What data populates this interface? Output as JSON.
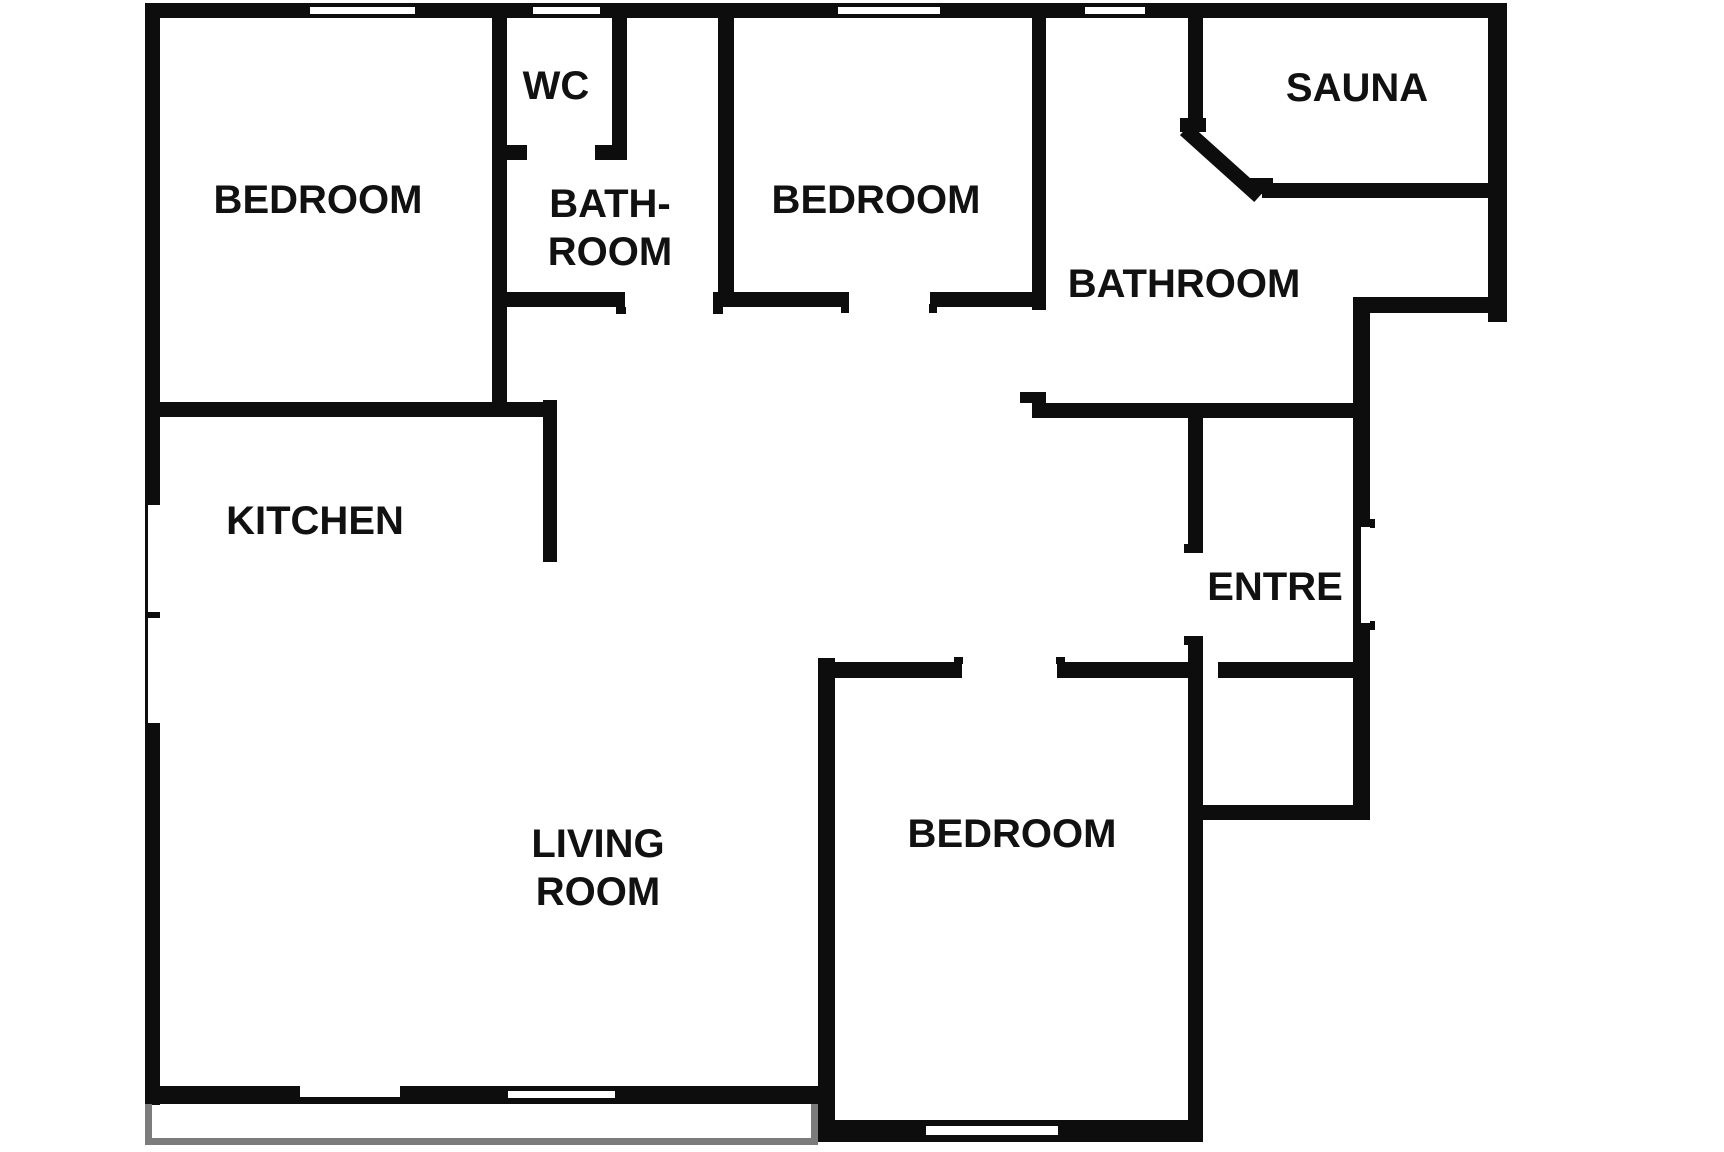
{
  "plan": {
    "canvas": {
      "width": 1724,
      "height": 1152
    },
    "colors": {
      "wall": "#0d0d0d",
      "background": "#ffffff",
      "balcony": "#7c7c7c",
      "text": "#111111"
    },
    "labels": [
      {
        "id": "bedroom-1",
        "text": "BEDROOM",
        "x": 318,
        "y": 200,
        "size": 40
      },
      {
        "id": "wc",
        "text": "WC",
        "x": 556,
        "y": 86,
        "size": 40
      },
      {
        "id": "bath-room",
        "text": "BATH-\nROOM",
        "x": 610,
        "y": 228,
        "size": 40
      },
      {
        "id": "bedroom-2",
        "text": "BEDROOM",
        "x": 876,
        "y": 200,
        "size": 40
      },
      {
        "id": "sauna",
        "text": "SAUNA",
        "x": 1357,
        "y": 88,
        "size": 40
      },
      {
        "id": "bathroom",
        "text": "BATHROOM",
        "x": 1184,
        "y": 284,
        "size": 40
      },
      {
        "id": "kitchen",
        "text": "KITCHEN",
        "x": 315,
        "y": 521,
        "size": 40
      },
      {
        "id": "entre",
        "text": "ENTRE",
        "x": 1275,
        "y": 587,
        "size": 40
      },
      {
        "id": "living-room",
        "text": "LIVING\nROOM",
        "x": 598,
        "y": 868,
        "size": 40
      },
      {
        "id": "bedroom-3",
        "text": "BEDROOM",
        "x": 1012,
        "y": 834,
        "size": 40
      }
    ],
    "walls": [
      {
        "name": "outer-top-wall",
        "x": 145,
        "y": 3,
        "w": 1362,
        "h": 15
      },
      {
        "name": "outer-left-wall",
        "x": 145,
        "y": 3,
        "w": 15,
        "h": 1102
      },
      {
        "name": "outer-right-wall",
        "x": 1488,
        "y": 3,
        "w": 19,
        "h": 319
      },
      {
        "name": "outer-step-wall",
        "x": 1353,
        "y": 297,
        "w": 154,
        "h": 16
      },
      {
        "name": "entre-right-outer-wall",
        "x": 1353,
        "y": 297,
        "w": 17,
        "h": 523
      },
      {
        "name": "livingroom-bottom-wall",
        "x": 145,
        "y": 1086,
        "w": 690,
        "h": 18
      },
      {
        "name": "bedroom3-bottom-wall",
        "x": 818,
        "y": 1120,
        "w": 385,
        "h": 22
      },
      {
        "name": "bedroom1-right-wall",
        "x": 492,
        "y": 18,
        "w": 15,
        "h": 389
      },
      {
        "name": "wc-right-wall",
        "x": 612,
        "y": 18,
        "w": 15,
        "h": 142
      },
      {
        "name": "wc-bottom-wall-left",
        "x": 492,
        "y": 145,
        "w": 35,
        "h": 15
      },
      {
        "name": "wc-bottom-wall-right",
        "x": 595,
        "y": 145,
        "w": 32,
        "h": 15
      },
      {
        "name": "bedroom2-left-wall",
        "x": 718,
        "y": 18,
        "w": 16,
        "h": 289
      },
      {
        "name": "hall-top-wall-a",
        "x": 492,
        "y": 292,
        "w": 133,
        "h": 15
      },
      {
        "name": "hall-top-wall-b",
        "x": 713,
        "y": 292,
        "w": 136,
        "h": 15
      },
      {
        "name": "hall-top-wall-c",
        "x": 930,
        "y": 292,
        "w": 116,
        "h": 15
      },
      {
        "name": "bedroom2-right-wall-upper",
        "x": 1032,
        "y": 18,
        "w": 14,
        "h": 292
      },
      {
        "name": "bathroom-left-wall-lower",
        "x": 1032,
        "y": 392,
        "w": 14,
        "h": 26
      },
      {
        "name": "kitchen-top-wall",
        "x": 145,
        "y": 402,
        "w": 412,
        "h": 15
      },
      {
        "name": "kitchen-right-wall",
        "x": 543,
        "y": 400,
        "w": 14,
        "h": 162
      },
      {
        "name": "sauna-left-wall",
        "x": 1188,
        "y": 18,
        "w": 15,
        "h": 110
      },
      {
        "name": "sauna-bottom-wall",
        "x": 1262,
        "y": 183,
        "w": 226,
        "h": 15
      },
      {
        "name": "bathroom-bottom-wall",
        "x": 1032,
        "y": 403,
        "w": 338,
        "h": 15
      },
      {
        "name": "entre-left-wall-upper",
        "x": 1188,
        "y": 415,
        "w": 15,
        "h": 138
      },
      {
        "name": "entre-left-wall-lower",
        "x": 1188,
        "y": 637,
        "w": 15,
        "h": 505
      },
      {
        "name": "bedroom3-top-wall-a",
        "x": 818,
        "y": 662,
        "w": 144,
        "h": 16
      },
      {
        "name": "bedroom3-top-wall-b",
        "x": 1057,
        "y": 662,
        "w": 146,
        "h": 16
      },
      {
        "name": "entre-bottom-wall",
        "x": 1218,
        "y": 662,
        "w": 152,
        "h": 16
      },
      {
        "name": "closet-bottom-wall",
        "x": 1188,
        "y": 805,
        "w": 182,
        "h": 15
      },
      {
        "name": "livingroom-bedroom3-divider",
        "x": 818,
        "y": 658,
        "w": 17,
        "h": 484
      }
    ],
    "nubs": [
      {
        "name": "bathroom-small-door-jamb-left",
        "x": 616,
        "y": 307,
        "w": 10,
        "h": 7
      },
      {
        "name": "bathroom-small-door-jamb-right",
        "x": 713,
        "y": 307,
        "w": 10,
        "h": 7
      },
      {
        "name": "bedroom2-door-jamb-left",
        "x": 841,
        "y": 304,
        "w": 8,
        "h": 9
      },
      {
        "name": "bedroom2-door-jamb-right",
        "x": 929,
        "y": 304,
        "w": 8,
        "h": 9
      },
      {
        "name": "bathroom-door-jamb",
        "x": 1020,
        "y": 392,
        "w": 12,
        "h": 11
      },
      {
        "name": "entre-door-jamb-top",
        "x": 1184,
        "y": 544,
        "w": 19,
        "h": 9
      },
      {
        "name": "entre-door-jamb-bottom",
        "x": 1184,
        "y": 636,
        "w": 19,
        "h": 9
      },
      {
        "name": "outer-door-jamb-top",
        "x": 1353,
        "y": 519,
        "w": 22,
        "h": 9
      },
      {
        "name": "outer-door-jamb-bottom",
        "x": 1353,
        "y": 621,
        "w": 22,
        "h": 9
      },
      {
        "name": "sauna-door-jamb-top",
        "x": 1180,
        "y": 118,
        "w": 26,
        "h": 14
      },
      {
        "name": "sauna-door-jamb-bottom",
        "x": 1247,
        "y": 178,
        "w": 26,
        "h": 16
      },
      {
        "name": "bedroom3-door-jamb-left",
        "x": 954,
        "y": 657,
        "w": 9,
        "h": 7
      },
      {
        "name": "bedroom3-door-jamb-right",
        "x": 1056,
        "y": 657,
        "w": 9,
        "h": 7
      }
    ],
    "diagonal": {
      "name": "sauna-diagonal-wall",
      "x": 1190,
      "y": 124,
      "len": 100,
      "h": 15,
      "angle": 42
    },
    "slots": [
      {
        "name": "window-top-bedroom1",
        "x": 310,
        "y": 7,
        "w": 105,
        "h": 7
      },
      {
        "name": "window-top-wc",
        "x": 533,
        "y": 7,
        "w": 67,
        "h": 7
      },
      {
        "name": "window-top-bedroom2",
        "x": 838,
        "y": 7,
        "w": 102,
        "h": 7
      },
      {
        "name": "window-top-bathroom",
        "x": 1085,
        "y": 7,
        "w": 60,
        "h": 7
      },
      {
        "name": "window-left-kitchen-a",
        "x": 148,
        "y": 505,
        "w": 12,
        "h": 107
      },
      {
        "name": "window-left-kitchen-b",
        "x": 148,
        "y": 618,
        "w": 12,
        "h": 105
      },
      {
        "name": "balcony-door-notch",
        "x": 300,
        "y": 1086,
        "w": 100,
        "h": 11
      },
      {
        "name": "window-bottom-living",
        "x": 508,
        "y": 1091,
        "w": 107,
        "h": 7
      },
      {
        "name": "window-bottom-bedroom3",
        "x": 926,
        "y": 1126,
        "w": 132,
        "h": 9
      },
      {
        "name": "entrance-door-notch",
        "x": 1361,
        "y": 527,
        "w": 9,
        "h": 96
      }
    ],
    "balcony": [
      {
        "name": "balcony-left-edge",
        "x": 145,
        "y": 1104,
        "w": 7,
        "h": 41
      },
      {
        "name": "balcony-bottom-edge",
        "x": 145,
        "y": 1138,
        "w": 673,
        "h": 7
      },
      {
        "name": "balcony-right-edge",
        "x": 811,
        "y": 1104,
        "w": 7,
        "h": 41
      }
    ]
  }
}
